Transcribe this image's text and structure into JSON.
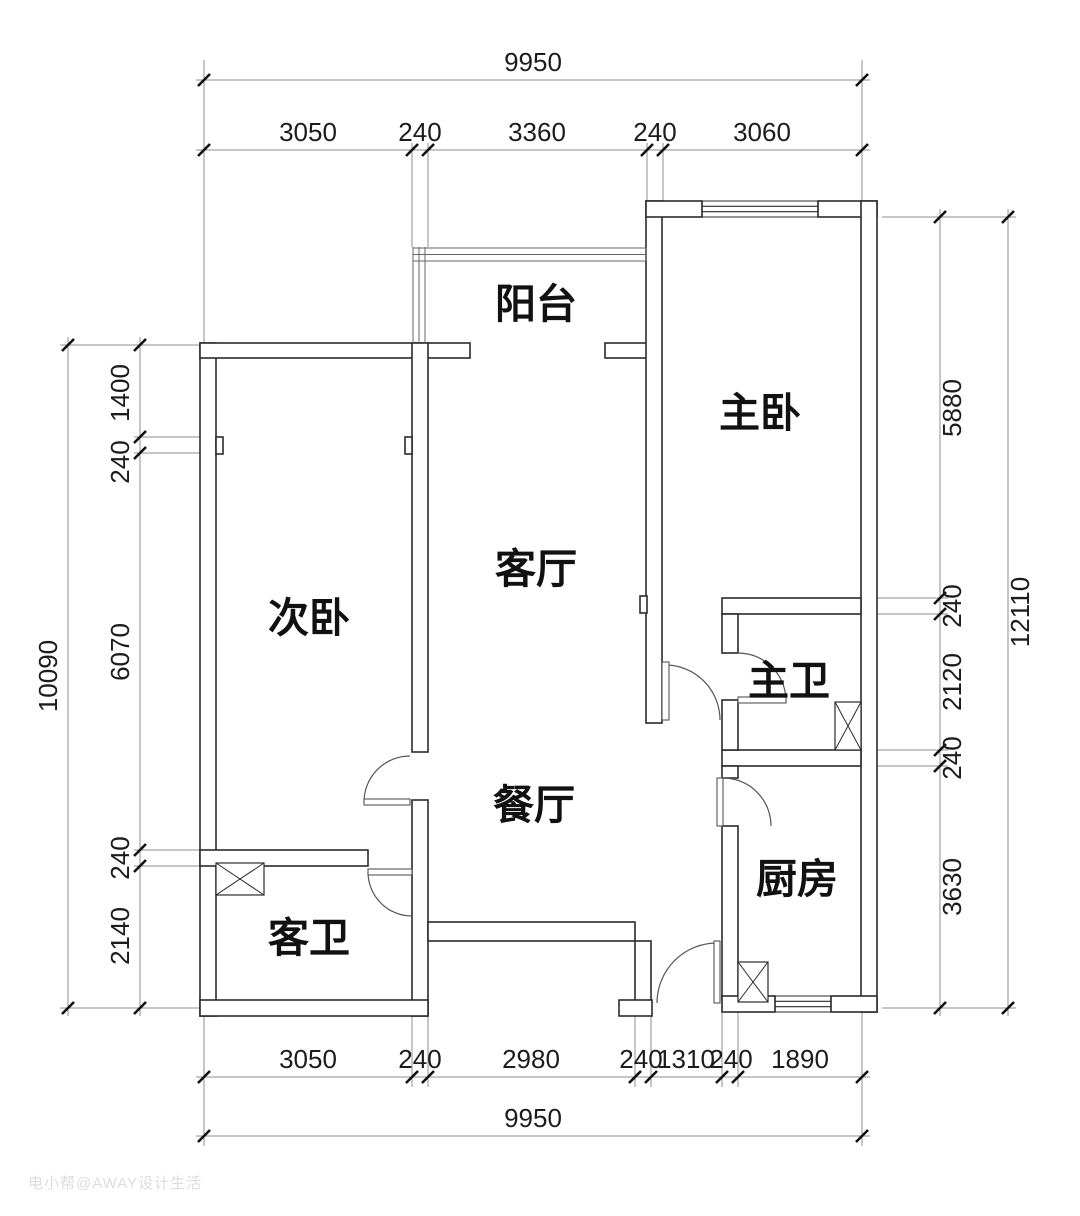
{
  "page": {
    "background": "#ffffff",
    "wall_color": "#2b2b2b",
    "dim_color": "#8f8f8f",
    "tick_color": "#111111",
    "text_color": "#1c1c1c",
    "door_color": "#555555",
    "rail_color": "#666666",
    "watermark": {
      "text": "电小帮@AWAY设计生活",
      "color": "#dcdcdc"
    }
  },
  "rooms": [
    {
      "id": "balcony",
      "label": "阳台",
      "x": 536,
      "y": 303
    },
    {
      "id": "master-bedroom",
      "label": "主卧",
      "x": 760,
      "y": 412
    },
    {
      "id": "second-bedroom",
      "label": "次卧",
      "x": 309,
      "y": 617
    },
    {
      "id": "living-room",
      "label": "客厅",
      "x": 536,
      "y": 568
    },
    {
      "id": "dining-room",
      "label": "餐厅",
      "x": 534,
      "y": 804
    },
    {
      "id": "master-bathroom",
      "label": "主卫",
      "x": 789,
      "y": 680
    },
    {
      "id": "kitchen",
      "label": "厨房",
      "x": 797,
      "y": 878
    },
    {
      "id": "guest-bathroom",
      "label": "客卫",
      "x": 309,
      "y": 937
    }
  ],
  "dim_rows": [
    {
      "orient": "h",
      "pos": 80,
      "from": 196,
      "to": 870,
      "label_offset": -9,
      "ticks": [
        204,
        862
      ],
      "labels": [
        {
          "text": "9950",
          "at": 533
        }
      ]
    },
    {
      "orient": "h",
      "pos": 150,
      "from": 196,
      "to": 870,
      "label_offset": -9,
      "ticks": [
        204,
        412,
        428,
        647,
        663,
        862
      ],
      "labels": [
        {
          "text": "3050",
          "at": 308
        },
        {
          "text": "240",
          "at": 420
        },
        {
          "text": "3360",
          "at": 537
        },
        {
          "text": "240",
          "at": 655
        },
        {
          "text": "3060",
          "at": 762
        }
      ]
    },
    {
      "orient": "h",
      "pos": 1077,
      "from": 196,
      "to": 870,
      "label_offset": -9,
      "ticks": [
        204,
        412,
        428,
        635,
        651,
        722,
        738,
        862
      ],
      "labels": [
        {
          "text": "3050",
          "at": 308
        },
        {
          "text": "240",
          "at": 420
        },
        {
          "text": "2980",
          "at": 531
        },
        {
          "text": "240",
          "at": 641
        },
        {
          "text": "1310",
          "at": 686
        },
        {
          "text": "240",
          "at": 731
        },
        {
          "text": "1890",
          "at": 800
        }
      ]
    },
    {
      "orient": "h",
      "pos": 1136,
      "from": 196,
      "to": 870,
      "label_offset": -9,
      "ticks": [
        204,
        862
      ],
      "labels": [
        {
          "text": "9950",
          "at": 533
        }
      ]
    },
    {
      "orient": "v",
      "pos": 68,
      "from": 337,
      "to": 1016,
      "label_offset": -11,
      "ticks": [
        345,
        1008
      ],
      "labels": [
        {
          "text": "10090",
          "at": 676
        }
      ]
    },
    {
      "orient": "v",
      "pos": 140,
      "from": 337,
      "to": 1016,
      "label_offset": -11,
      "ticks": [
        345,
        437,
        453,
        850,
        866,
        1008
      ],
      "labels": [
        {
          "text": "1400",
          "at": 393
        },
        {
          "text": "240",
          "at": 462
        },
        {
          "text": "6070",
          "at": 652
        },
        {
          "text": "240",
          "at": 858
        },
        {
          "text": "2140",
          "at": 936
        }
      ]
    },
    {
      "orient": "v",
      "pos": 940,
      "from": 209,
      "to": 1016,
      "label_offset": 21,
      "ticks": [
        217,
        598,
        614,
        750,
        766,
        1008
      ],
      "labels": [
        {
          "text": "5880",
          "at": 408
        },
        {
          "text": "240",
          "at": 606
        },
        {
          "text": "2120",
          "at": 682
        },
        {
          "text": "240",
          "at": 758
        },
        {
          "text": "3630",
          "at": 887
        }
      ]
    },
    {
      "orient": "v",
      "pos": 1008,
      "from": 209,
      "to": 1016,
      "label_offset": 21,
      "ticks": [
        217,
        1008
      ],
      "labels": [
        {
          "text": "12110",
          "at": 612
        }
      ]
    }
  ],
  "extension_lines": [
    [
      204,
      60,
      204,
      343
    ],
    [
      862,
      60,
      862,
      201
    ],
    [
      412,
      143,
      412,
      247
    ],
    [
      428,
      143,
      428,
      247
    ],
    [
      647,
      143,
      647,
      201
    ],
    [
      663,
      143,
      663,
      201
    ],
    [
      204,
      1016,
      204,
      1146
    ],
    [
      862,
      1012,
      862,
      1146
    ],
    [
      412,
      1016,
      412,
      1087
    ],
    [
      428,
      1016,
      428,
      1087
    ],
    [
      635,
      1016,
      635,
      1087
    ],
    [
      651,
      1016,
      651,
      1087
    ],
    [
      722,
      1012,
      722,
      1087
    ],
    [
      738,
      1012,
      738,
      1087
    ],
    [
      60,
      345,
      200,
      345
    ],
    [
      60,
      1008,
      200,
      1008
    ],
    [
      134,
      437,
      216,
      437
    ],
    [
      134,
      453,
      216,
      453
    ],
    [
      134,
      850,
      200,
      850
    ],
    [
      134,
      866,
      200,
      866
    ],
    [
      882,
      217,
      1016,
      217
    ],
    [
      882,
      1008,
      1016,
      1008
    ],
    [
      866,
      598,
      948,
      598
    ],
    [
      866,
      614,
      948,
      614
    ],
    [
      866,
      750,
      948,
      750
    ],
    [
      866,
      766,
      948,
      766
    ]
  ],
  "walls": [
    [
      200,
      343,
      16,
      673
    ],
    [
      200,
      343,
      270,
      15
    ],
    [
      605,
      343,
      42,
      15
    ],
    [
      412,
      343,
      16,
      409
    ],
    [
      412,
      800,
      16,
      216
    ],
    [
      216,
      437,
      7,
      17
    ],
    [
      405,
      437,
      7,
      17
    ],
    [
      200,
      850,
      168,
      16
    ],
    [
      200,
      1000,
      228,
      16
    ],
    [
      428,
      922,
      207,
      19
    ],
    [
      635,
      941,
      16,
      60
    ],
    [
      619,
      1000,
      33,
      16
    ],
    [
      646,
      201,
      16,
      522
    ],
    [
      640,
      596,
      7,
      17
    ],
    [
      646,
      201,
      56,
      16
    ],
    [
      818,
      201,
      59,
      16
    ],
    [
      861,
      201,
      16,
      811
    ],
    [
      722,
      598,
      139,
      16
    ],
    [
      722,
      750,
      139,
      16
    ],
    [
      722,
      614,
      16,
      39
    ],
    [
      722,
      700,
      16,
      50
    ],
    [
      722,
      766,
      16,
      12
    ],
    [
      722,
      826,
      16,
      174
    ],
    [
      722,
      996,
      53,
      16
    ],
    [
      831,
      996,
      46,
      16
    ]
  ],
  "windows": [
    {
      "x1": 702,
      "x2": 818,
      "y1": 201,
      "y2": 217
    },
    {
      "x1": 775,
      "x2": 831,
      "y1": 996,
      "y2": 1012
    }
  ],
  "railings": {
    "vertical": {
      "xs": [
        413,
        419,
        425
      ],
      "y1": 247,
      "y2": 343
    },
    "horizontal": {
      "ys": [
        248,
        254.5,
        261
      ],
      "x1": 413,
      "x2": 646
    }
  },
  "doors": [
    {
      "id": "second-bedroom-door",
      "leaf": [
        364,
        799,
        46,
        6
      ],
      "arc": "M410,756 A46,46 0 0 0 364,802"
    },
    {
      "id": "guest-bathroom-door",
      "leaf": [
        368,
        869,
        44,
        6
      ],
      "arc": "M368,872 A44,44 0 0 0 412,916"
    },
    {
      "id": "master-bedroom-door",
      "leaf": [
        662,
        662,
        7,
        58
      ],
      "arc": "M667,665 A55,55 0 0 1 720,720"
    },
    {
      "id": "master-bathroom-door",
      "leaf": [
        738,
        697,
        48,
        6
      ],
      "arc": "M738,653 A48,48 0 0 1 786,701"
    },
    {
      "id": "kitchen-door",
      "leaf": [
        717,
        778,
        6,
        48
      ],
      "arc": "M723,778 A48,48 0 0 1 771,826"
    },
    {
      "id": "entry-door",
      "leaf": [
        714,
        941,
        6,
        62
      ],
      "arc": "M657,1003 A60,60 0 0 1 717,943"
    }
  ],
  "shafts": [
    [
      216,
      863,
      48,
      32
    ],
    [
      835,
      702,
      26,
      48
    ],
    [
      738,
      962,
      30,
      40
    ]
  ]
}
